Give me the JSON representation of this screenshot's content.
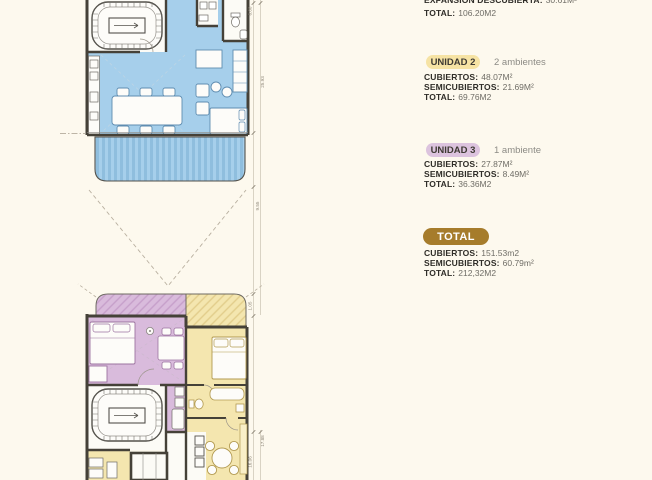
{
  "colors": {
    "background": "#fdf9ee",
    "unit1_blue": "#a6cfeb",
    "unit2_yellow": "#f4e6af",
    "unit3_purple": "#d9bbdc",
    "badge_unit2": "#f6e3a4",
    "badge_unit3": "#dcc3de",
    "badge_total": "#a67c2b",
    "wall": "#454138"
  },
  "plan": {
    "dims": {
      "top_inner": "6.00",
      "top_span": "25.93",
      "top_lower": "9.55",
      "terrace": "1.05",
      "bottom_outer": "17.88",
      "bottom_inner": "16.06"
    }
  },
  "info": {
    "unit1": {
      "line1_label": "EXPANSIÓN DESCUBIERTA:",
      "line1_value": "30.61M²",
      "line2_label": "TOTAL:",
      "line2_value": "106.20M2"
    },
    "unit2": {
      "badge": "UNIDAD 2",
      "subtitle": "2 ambientes",
      "rows": [
        {
          "label": "CUBIERTOS:",
          "value": "48.07M²"
        },
        {
          "label": "SEMICUBIERTOS:",
          "value": "21.69M²"
        },
        {
          "label": "TOTAL:",
          "value": "69.76M2"
        }
      ]
    },
    "unit3": {
      "badge": "UNIDAD 3",
      "subtitle": "1 ambiente",
      "rows": [
        {
          "label": "CUBIERTOS:",
          "value": "27.87M²"
        },
        {
          "label": "SEMICUBIERTOS:",
          "value": "8.49M²"
        },
        {
          "label": "TOTAL:",
          "value": "36.36M2"
        }
      ]
    },
    "total": {
      "badge": "TOTAL",
      "rows": [
        {
          "label": "CUBIERTOS:",
          "value": "151.53m2"
        },
        {
          "label": "SEMICUBIERTOS:",
          "value": "60.79m²"
        },
        {
          "label": "TOTAL:",
          "value": "212,32M2"
        }
      ]
    }
  }
}
